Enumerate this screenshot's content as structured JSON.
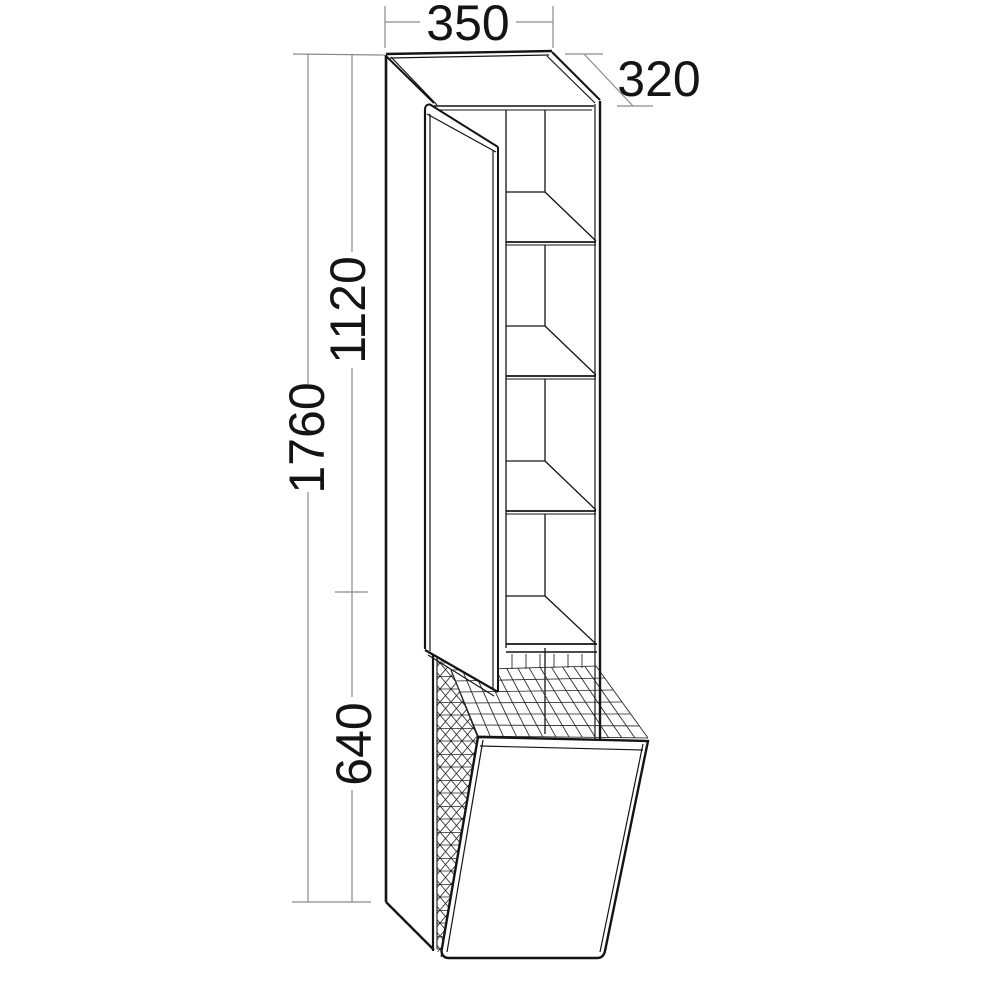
{
  "drawing": {
    "type": "furniture technical drawing",
    "subject": "tall bathroom cabinet with open hinged door, 4 interior shelves and tilt-out wire laundry basket",
    "background": "#ffffff",
    "line_color": "#141414",
    "dimension_color": "#8a8a8a",
    "shelf_count": 4,
    "labels": {
      "width": "350",
      "depth": "320",
      "total_height": "1760",
      "upper_height": "1120",
      "lower_height": "640"
    }
  }
}
